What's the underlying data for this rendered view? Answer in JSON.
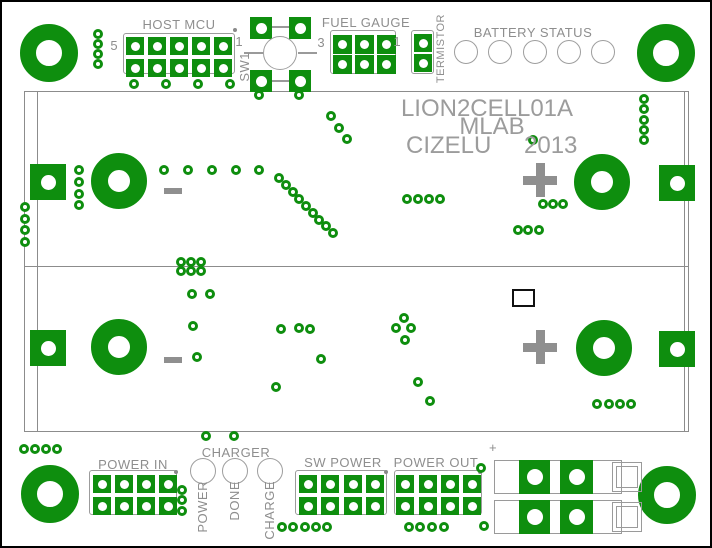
{
  "colors": {
    "copper": "#0e8e0e",
    "silk": "#8e8e8e",
    "title_gray": "#9c9c9c",
    "battery_line": "#8c8c8c",
    "frame": "#000000",
    "background": "#ffffff"
  },
  "title_block": {
    "line1": "LION2CELL01A",
    "line2": "MLAB",
    "line3_left": "CIZELU",
    "line3_right": "2013",
    "line1_cx": 485,
    "line1_top": 93,
    "line2_cx": 490,
    "line2_top": 111,
    "left3_x": 404,
    "right3_x": 522,
    "line3_top": 130
  },
  "headers": [
    {
      "id": "host-mcu",
      "label": "HOST MCU",
      "label_cx": 177,
      "label_cy": 15,
      "left_pin": "5",
      "right_pin": "1",
      "left_pin_x": 112,
      "left_pin_y": 36,
      "right_pin_x": 237,
      "right_pin_y": 32,
      "outline": [
        121,
        31,
        112,
        41
      ],
      "pad": 18,
      "hole": 9,
      "cols": [
        124,
        146,
        168,
        190,
        212
      ],
      "rows": [
        35,
        57
      ],
      "dot": [
        233,
        28
      ]
    },
    {
      "id": "fuel-gauge",
      "label": "FUEL GAUGE",
      "label_cx": 364,
      "label_cy": 13,
      "left_pin": "3",
      "right_pin": "1",
      "left_pin_x": 319,
      "left_pin_y": 33,
      "right_pin_x": 395,
      "right_pin_y": 32,
      "outline": [
        328,
        28,
        66,
        44
      ],
      "pad": 19,
      "hole": 9,
      "cols": [
        331,
        353,
        375
      ],
      "rows": [
        33,
        53
      ]
    },
    {
      "id": "termistor",
      "vlabel": "TERMISTOR",
      "vlabel_x": 433,
      "vlabel_top": 12,
      "outline": [
        409,
        28,
        23,
        44
      ],
      "pad": 18,
      "hole": 9,
      "cols": [
        412
      ],
      "rows": [
        32,
        52
      ]
    },
    {
      "id": "power-in",
      "label": "POWER IN",
      "label_cx": 131,
      "label_cy": 455,
      "outline": [
        87,
        468,
        88,
        45
      ],
      "pad": 18,
      "hole": 9,
      "cols": [
        91,
        113,
        135,
        157
      ],
      "rows": [
        473,
        495
      ],
      "dot": [
        174,
        470
      ]
    },
    {
      "id": "sw-power",
      "label": "SW POWER",
      "label_cx": 341,
      "label_cy": 453,
      "outline": [
        293,
        468,
        92,
        45
      ],
      "pad": 18,
      "hole": 9,
      "cols": [
        297,
        319,
        342,
        364
      ],
      "rows": [
        473,
        495
      ],
      "dot": [
        384,
        470
      ]
    },
    {
      "id": "power-out",
      "label": "POWER OUT",
      "label_cx": 434,
      "label_cy": 453,
      "outline": [
        392,
        468,
        88,
        45
      ],
      "pad": 18,
      "hole": 9,
      "cols": [
        394,
        417,
        439,
        461
      ],
      "rows": [
        473,
        495
      ],
      "dot": [
        478,
        470
      ]
    }
  ],
  "sw1": {
    "label": "SW1",
    "vlabel_x": 235,
    "vlabel_top": 50,
    "pad_size": 22,
    "hole": 11,
    "pads": [
      [
        248,
        15
      ],
      [
        287,
        15
      ],
      [
        248,
        68
      ],
      [
        287,
        68
      ]
    ],
    "circle": [
      278,
      51,
      17
    ],
    "lines": [
      [
        270,
        24,
        17,
        1.5
      ],
      [
        270,
        78,
        17,
        1.5
      ],
      [
        242,
        50,
        19,
        1.5
      ],
      [
        296,
        50,
        19,
        1.5
      ]
    ]
  },
  "battery_status": {
    "label": "BATTERY STATUS",
    "label_cx": 531,
    "label_cy": 23,
    "led_y": 50,
    "led_r": 12,
    "led_xs": [
      464,
      498,
      533,
      567,
      601
    ]
  },
  "charger": {
    "label": "CHARGER",
    "label_cx": 234,
    "label_cy": 443,
    "pad_y": 469,
    "pad_r": 13,
    "vlabel_top": 479,
    "pads": [
      {
        "x": 201,
        "vlabel": "POWER"
      },
      {
        "x": 233,
        "vlabel": "DONE"
      },
      {
        "x": 268,
        "vlabel": "CHARGE"
      }
    ]
  },
  "battery_holder": {
    "rect": [
      22,
      89,
      665,
      341
    ],
    "inner_left_x": 35,
    "inner_right_x": 682,
    "divider_y": 264,
    "contact_size": 36,
    "contact_hole": 15,
    "donut_size": 56,
    "donut_border": 17,
    "cells": [
      {
        "minus": [
          171,
          189
        ],
        "plus": [
          538,
          178
        ],
        "donut_l": [
          117,
          179
        ],
        "donut_r": [
          600,
          180
        ],
        "pad_l": [
          28,
          162
        ],
        "pad_r": [
          657,
          163
        ]
      },
      {
        "minus": [
          171,
          358
        ],
        "plus": [
          538,
          345
        ],
        "donut_l": [
          117,
          345
        ],
        "donut_r": [
          602,
          346
        ],
        "pad_l": [
          28,
          328
        ],
        "pad_r": [
          657,
          329
        ]
      }
    ]
  },
  "mount_holes": {
    "size": 58,
    "border": 16,
    "centers": [
      [
        47,
        51
      ],
      [
        664,
        51
      ],
      [
        48,
        492
      ],
      [
        665,
        493
      ]
    ]
  },
  "terminal_block": {
    "plus_label": "+",
    "plus_x": 487,
    "plus_y": 438,
    "rows": [
      [
        492,
        458,
        128,
        34
      ],
      [
        492,
        498,
        128,
        34
      ]
    ],
    "pads": [
      [
        517,
        458,
        31,
        34
      ],
      [
        558,
        458,
        33,
        34
      ],
      [
        517,
        498,
        31,
        34
      ],
      [
        558,
        498,
        33,
        34
      ]
    ],
    "pad_hole": 16,
    "squares": [
      [
        610,
        460,
        30,
        30
      ],
      [
        610,
        500,
        30,
        30
      ]
    ],
    "inner_inset": 4
  },
  "square_outline": [
    510,
    287,
    23,
    18
  ],
  "vias": [
    [
      96,
      32
    ],
    [
      96,
      42
    ],
    [
      96,
      52
    ],
    [
      96,
      62
    ],
    [
      132,
      82
    ],
    [
      164,
      82
    ],
    [
      196,
      82
    ],
    [
      228,
      82
    ],
    [
      257,
      93
    ],
    [
      297,
      93
    ],
    [
      642,
      97
    ],
    [
      642,
      107
    ],
    [
      642,
      118
    ],
    [
      642,
      128
    ],
    [
      642,
      138
    ],
    [
      329,
      114
    ],
    [
      337,
      126
    ],
    [
      345,
      137
    ],
    [
      77,
      168
    ],
    [
      77,
      180
    ],
    [
      77,
      192
    ],
    [
      77,
      203
    ],
    [
      23,
      205
    ],
    [
      23,
      217
    ],
    [
      23,
      228
    ],
    [
      23,
      240
    ],
    [
      162,
      168
    ],
    [
      186,
      168
    ],
    [
      210,
      168
    ],
    [
      234,
      168
    ],
    [
      257,
      168
    ],
    [
      277,
      176
    ],
    [
      284,
      183
    ],
    [
      291,
      190
    ],
    [
      297,
      197
    ],
    [
      304,
      204
    ],
    [
      311,
      211
    ],
    [
      317,
      218
    ],
    [
      324,
      224
    ],
    [
      331,
      231
    ],
    [
      405,
      197
    ],
    [
      416,
      197
    ],
    [
      427,
      197
    ],
    [
      438,
      197
    ],
    [
      541,
      202
    ],
    [
      551,
      202
    ],
    [
      561,
      202
    ],
    [
      516,
      228
    ],
    [
      526,
      228
    ],
    [
      537,
      228
    ],
    [
      531,
      138
    ],
    [
      179,
      260
    ],
    [
      189,
      260
    ],
    [
      199,
      260
    ],
    [
      179,
      269
    ],
    [
      189,
      269
    ],
    [
      199,
      269
    ],
    [
      190,
      292
    ],
    [
      208,
      292
    ],
    [
      191,
      324
    ],
    [
      195,
      355
    ],
    [
      279,
      327
    ],
    [
      297,
      326
    ],
    [
      308,
      327
    ],
    [
      319,
      357
    ],
    [
      274,
      385
    ],
    [
      402,
      316
    ],
    [
      394,
      326
    ],
    [
      409,
      326
    ],
    [
      403,
      338
    ],
    [
      416,
      380
    ],
    [
      428,
      399
    ],
    [
      595,
      402
    ],
    [
      607,
      402
    ],
    [
      618,
      402
    ],
    [
      629,
      402
    ],
    [
      22,
      447
    ],
    [
      33,
      447
    ],
    [
      44,
      447
    ],
    [
      55,
      447
    ],
    [
      204,
      434
    ],
    [
      232,
      434
    ],
    [
      180,
      488
    ],
    [
      180,
      498
    ],
    [
      180,
      509
    ],
    [
      280,
      525
    ],
    [
      291,
      525
    ],
    [
      303,
      525
    ],
    [
      314,
      525
    ],
    [
      325,
      525
    ],
    [
      407,
      525
    ],
    [
      418,
      525
    ],
    [
      430,
      525
    ],
    [
      442,
      525
    ],
    [
      482,
      524
    ],
    [
      479,
      466
    ]
  ]
}
